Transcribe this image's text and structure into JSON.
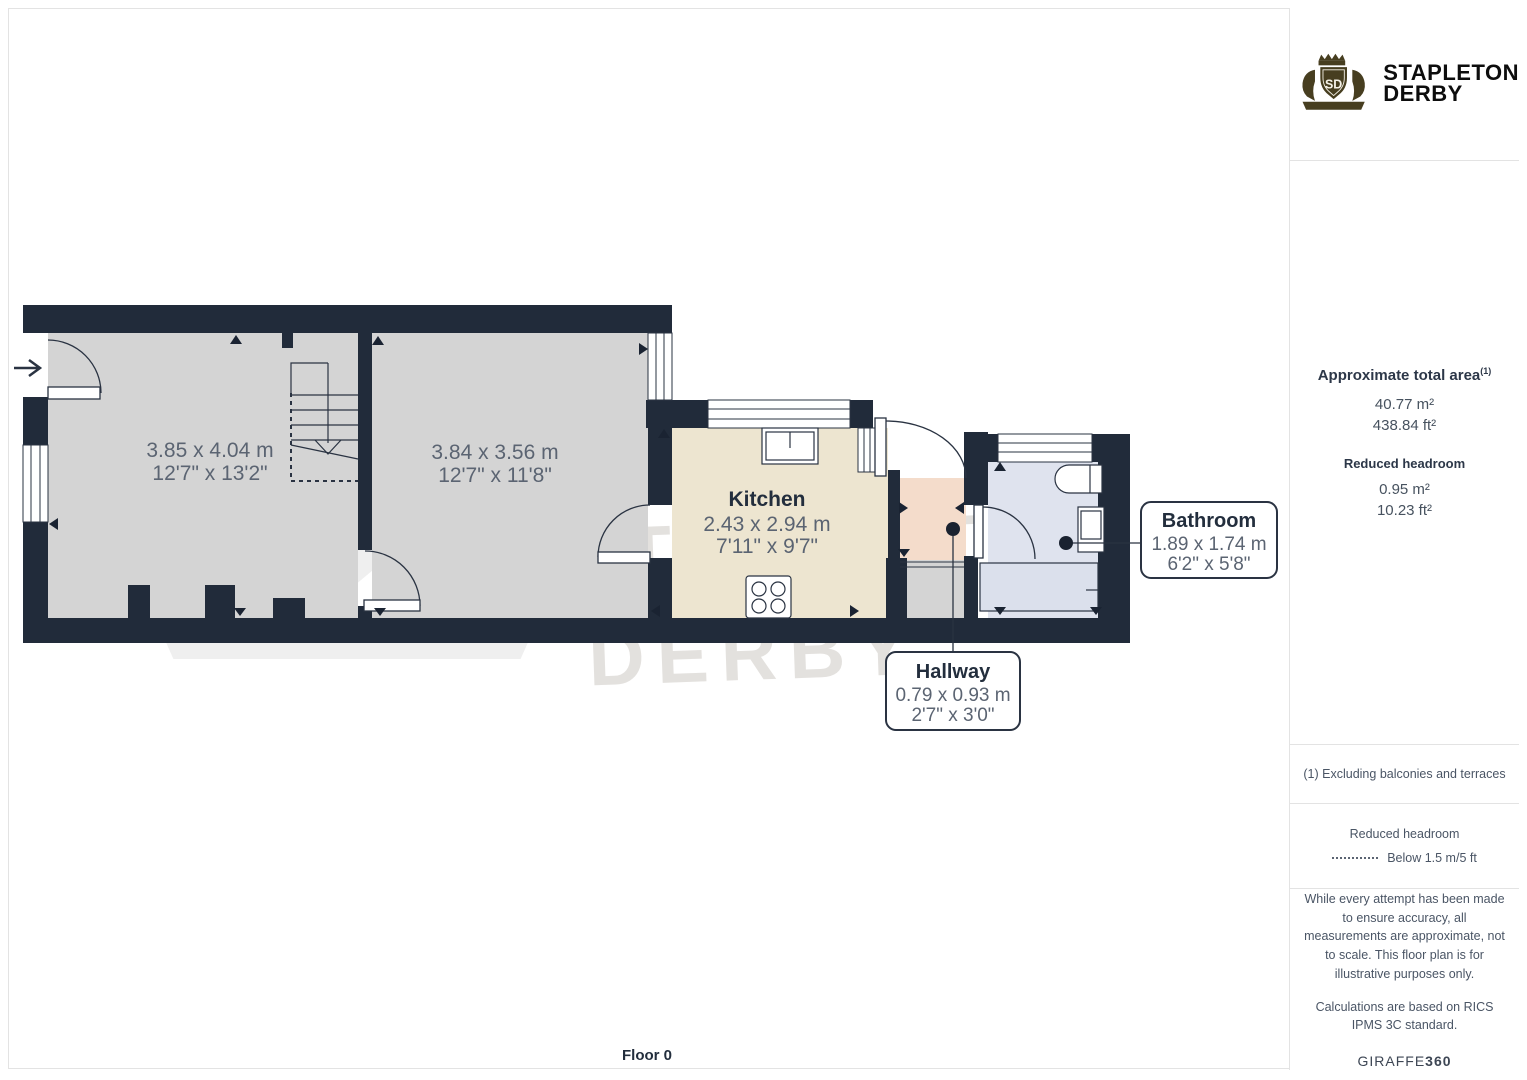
{
  "floorplan": {
    "floor_label": "Floor 0",
    "rooms": {
      "room1": {
        "dims_m": "3.85 x 4.04 m",
        "dims_ft": "12'7\" x 13'2\""
      },
      "room2": {
        "dims_m": "3.84 x 3.56 m",
        "dims_ft": "12'7\" x 11'8\""
      },
      "kitchen": {
        "name": "Kitchen",
        "dims_m": "2.43 x 2.94 m",
        "dims_ft": "7'11\" x 9'7\""
      },
      "hallway": {
        "name": "Hallway",
        "dims_m": "0.79 x 0.93 m",
        "dims_ft": "2'7\" x 3'0\""
      },
      "bathroom": {
        "name": "Bathroom",
        "dims_m": "1.89 x 1.74 m",
        "dims_ft": "6'2\" x 5'8\""
      }
    },
    "colors": {
      "wall": "#212b3a",
      "room_floor": "#d4d4d4",
      "kitchen_floor": "#ede5d0",
      "hallway_floor": "#f4dccb",
      "bathroom_floor": "#dfe3ee",
      "label_gray": "#5b6472",
      "label_dark": "#232e3d"
    }
  },
  "watermark": {
    "line1": "STAPLETON",
    "line2": "DERBY",
    "monogram": "SD"
  },
  "sidebar": {
    "logo": {
      "brand_line1": "STAPLETON",
      "brand_line2": "DERBY",
      "monogram": "SD",
      "crest_color": "#473e20"
    },
    "area": {
      "title": "Approximate total area",
      "title_superscript": "(1)",
      "total_m2": "40.77 m²",
      "total_ft2": "438.84 ft²",
      "reduced_title": "Reduced headroom",
      "reduced_m2": "0.95 m²",
      "reduced_ft2": "10.23 ft²"
    },
    "note": "(1) Excluding balconies and terraces",
    "legend": {
      "title": "Reduced headroom",
      "item": "Below 1.5 m/5 ft"
    },
    "disclaimer1": "While every attempt has been made to ensure accuracy, all measurements are approximate, not to scale. This floor plan is for illustrative purposes only.",
    "disclaimer2": "Calculations are based on RICS IPMS 3C standard.",
    "brand_footer": {
      "name": "GIRAFFE",
      "suffix": "360"
    }
  }
}
